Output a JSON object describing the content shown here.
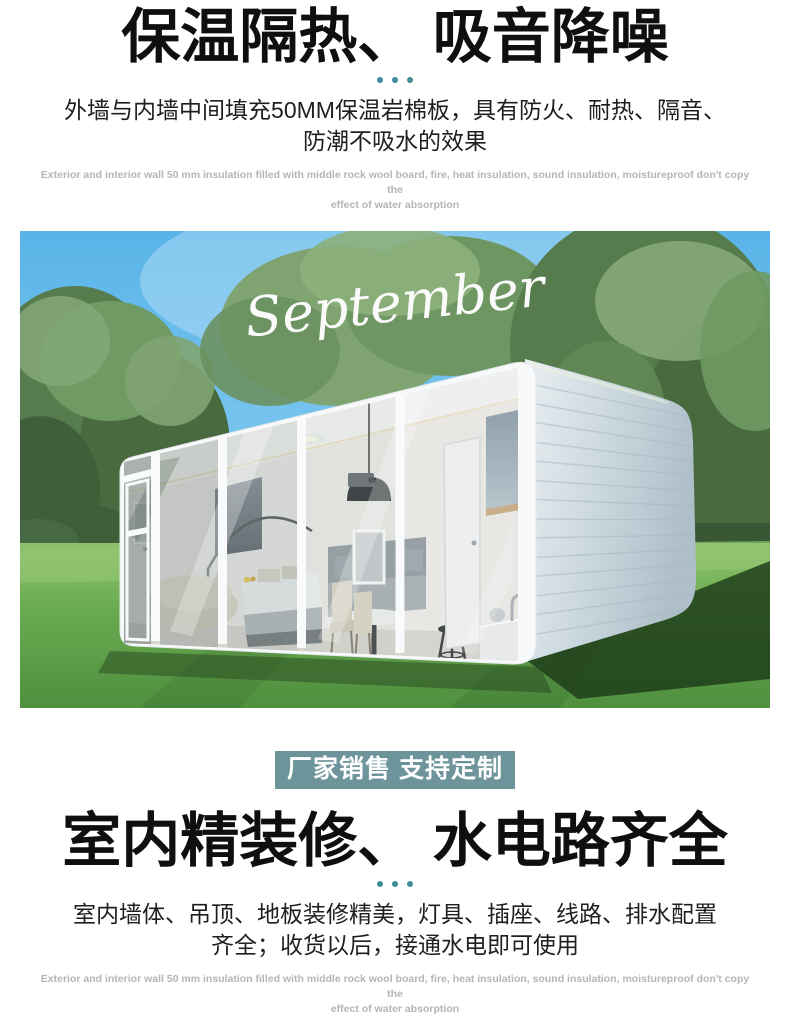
{
  "colors": {
    "accent_teal_dots": "#3f8d99",
    "badge_bg": "#6e949b",
    "heading_text": "#0f0f0f",
    "body_text": "#1f1f1f",
    "caption_gray": "#b5b5b5",
    "sky_blue": "#66bbea",
    "grass_green": "#5da04a",
    "cabin_white": "#f6f8f9"
  },
  "section_top": {
    "heading": "保温隔热、 吸音降噪",
    "subtitle_line1": "外墙与内墙中间填充50MM保温岩棉板，具有防火、耐热、隔音、",
    "subtitle_line2": "防潮不吸水的效果",
    "caption_en_line1": "Exterior and interior wall 50 mm insulation filled with middle rock wool board, fire, heat insulation, sound insulation, moistureproof don't copy the",
    "caption_en_line2": "effect of water absorption"
  },
  "hero_photo": {
    "overlay_text": "September"
  },
  "badge": {
    "label": "厂家销售 支持定制"
  },
  "section_bottom": {
    "heading": "室内精装修、 水电路齐全",
    "subtitle_line1": "室内墙体、吊顶、地板装修精美，灯具、插座、线路、排水配置",
    "subtitle_line2": "齐全；收货以后，接通水电即可使用",
    "caption_en_line1": "Exterior and interior wall 50 mm insulation filled with middle rock wool board, fire, heat insulation, sound insulation, moistureproof don't copy the",
    "caption_en_line2": "effect of water absorption"
  }
}
